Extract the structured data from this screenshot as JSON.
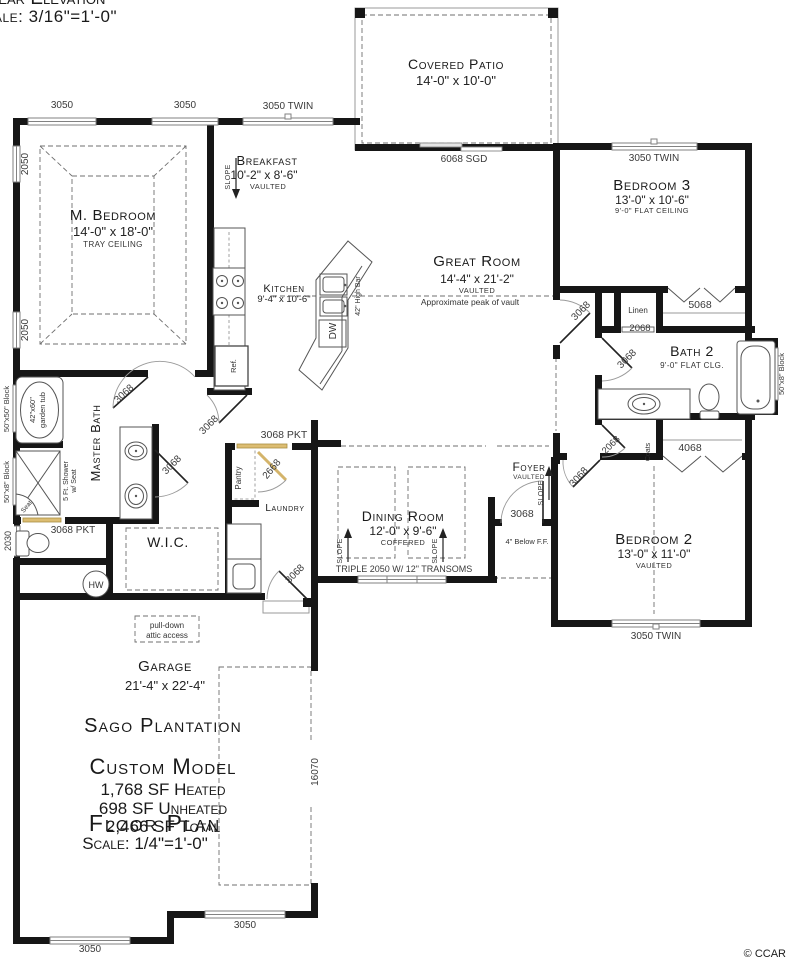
{
  "header": {
    "elevation_title": "Rear Elevation",
    "elevation_scale": "Scale: 3/16\"=1'-0\""
  },
  "title_block": {
    "community": "Sago Plantation",
    "model": "Custom Model",
    "heated": "1,768 SF Heated",
    "unheated": "698 SF Unheated",
    "total": "2,466 SF Total",
    "plan_title": "Floor Plan",
    "plan_scale": "Scale: 1/4\"=1'-0\""
  },
  "footer": {
    "copyright": "© CCAR"
  },
  "rooms": {
    "patio": {
      "name": "Covered Patio",
      "dims": "14'-0\" x 10'-0\""
    },
    "master_bedroom": {
      "name": "M. Bedroom",
      "dims": "14'-0\" x 18'-0\"",
      "note": "Tray Ceiling"
    },
    "breakfast": {
      "name": "Breakfast",
      "dims": "10'-2\" x 8'-6\"",
      "note": "Vaulted"
    },
    "kitchen": {
      "name": "Kitchen",
      "dims": "9'-4\" x 10'-6\""
    },
    "great_room": {
      "name": "Great Room",
      "dims": "14'-4\" x 21'-2\"",
      "note": "Vaulted",
      "peak_note": "Approximate peak of vault"
    },
    "bedroom3": {
      "name": "Bedroom 3",
      "dims": "13'-0\" x 10'-6\"",
      "note": "9'-0\" Flat Ceiling"
    },
    "bath2": {
      "name": "Bath 2",
      "note": "9'-0\" Flat Clg."
    },
    "bedroom2": {
      "name": "Bedroom 2",
      "dims": "13'-0\" x 11'-0\"",
      "note": "Vaulted"
    },
    "dining": {
      "name": "Dining Room",
      "dims": "12'-0\" x 9'-6\"",
      "note": "Coffered"
    },
    "foyer": {
      "name": "Foyer",
      "note": "Vaulted",
      "floor_note": "4\" Below F.F."
    },
    "laundry": {
      "name": "Laundry"
    },
    "pantry": {
      "name": "Pantry"
    },
    "wic": {
      "name": "W.I.C."
    },
    "master_bath": {
      "name": "Master Bath"
    },
    "garage": {
      "name": "Garage",
      "dims": "21'-4\" x 22'-4\""
    },
    "linen": {
      "name": "Linen"
    },
    "coats": {
      "name": "Coats"
    }
  },
  "openings": {
    "win_mbr_1": "3050",
    "win_mbr_2": "3050",
    "win_breakfast": "3050 TWIN",
    "door_patio": "6068 SGD",
    "win_bed3": "3050 TWIN",
    "win_mbr_side_1": "2050",
    "win_mbr_side_2": "2050",
    "win_tub": "50\"x50\" Block",
    "win_shower": "50\"x8\" Block",
    "win_toilet": "2030",
    "win_bath2": "50\"x8\" Block",
    "win_dining": "TRIPLE 2050 W/ 12\" TRANSOMS",
    "win_bed2": "3050 TWIN",
    "win_garage_side": "3050",
    "win_garage_front": "3050",
    "garage_door": "16070",
    "door_mbr": "3068",
    "door_mbath_pocket": "3068 PKT",
    "door_hall_pocket": "3068 PKT",
    "door_vestibule": "3068",
    "door_wic": "3068",
    "door_pantry": "2668",
    "door_garage": "3068",
    "door_foyer": "3068",
    "door_bed3": "3068",
    "door_bath2": "3068",
    "door_linen": "2068",
    "door_coats": "2068",
    "door_bed2": "3068",
    "closet_bed3": "5068",
    "closet_bed2": "4068"
  },
  "fixtures": {
    "water_heater": "HW",
    "fridge": "Ref.",
    "dishwasher": "DW",
    "bar": "42\" High Bar",
    "tub_line1": "42\"x60\"",
    "tub_line2": "garden tub",
    "shower_line1": "5 Ft. Shower",
    "shower_line2": "w/ Seat",
    "seat": "Seat",
    "attic_line1": "pull-down",
    "attic_line2": "attic access",
    "slope": "Slope"
  }
}
